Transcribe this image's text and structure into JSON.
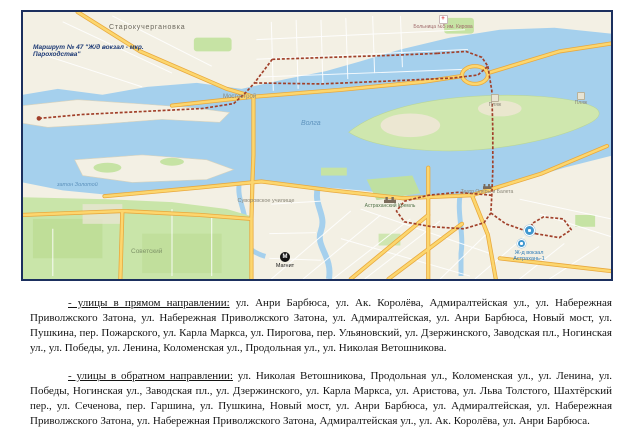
{
  "map": {
    "route_label": {
      "line1": "Маршрут № 47 \"Ж/д вокзал - мкр.",
      "line2": "Пароходства\""
    },
    "labels": {
      "town": "Старокучергановка",
      "district": "Мостострой",
      "river": "Волга",
      "bay": "затон Золотой",
      "gardens": "Советский",
      "school": "Суворовское училище",
      "kremlin": "Астраханский Кремль",
      "theatre": "Театр Оперы и Балета",
      "beach1": "Пляж",
      "beach2": "Пляж",
      "hospital": "Больница №5 им. Кирова",
      "station": "Ж-д вокзал Астрахань-1",
      "store": "Магнит"
    },
    "colors": {
      "water": "#a5d0ed",
      "land": "#f3f0e4",
      "route": "#a1402a",
      "road_fill": "#fcd66e",
      "road_casing": "#e9a93d",
      "border": "#1b2f5e"
    }
  },
  "document": {
    "paragraphs": [
      {
        "lead": "- улицы в прямом направлении:",
        "body": " ул. Анри Барбюса, ул. Ак. Королёва, Адмиралтейская ул., ул. Набережная Приволжского Затона, ул. Набережная Приволжского Затона, ул. Адмиралтейская, ул. Анри Барбюса, Новый мост, ул. Пушкина, пер. Пожарского, ул. Карла Маркса, ул. Пирогова, пер. Ульяновский, ул. Дзержинского, Заводская пл., Ногинская ул., ул. Победы, ул. Ленина, Коломенская ул., Продольная ул., ул. Николая Ветошникова."
      },
      {
        "lead": "- улицы в обратном направлении:",
        "body": " ул. Николая Ветошникова, Продольная ул., Коломенская ул., ул. Ленина, ул. Победы, Ногинская ул., Заводская пл., ул. Дзержинского, ул. Карла Маркса, ул. Аристова, ул. Льва Толстого, Шахтёрский пер., ул. Сеченова, пер. Гаршина, ул. Пушкина, Новый мост, ул. Анри Барбюса, ул. Адмиралтейская, ул. Набережная Приволжского Затона, ул. Набережная Приволжского Затона, Адмиралтейская ул., ул. Ак. Королёва, ул. Анри Барбюса."
      }
    ]
  }
}
